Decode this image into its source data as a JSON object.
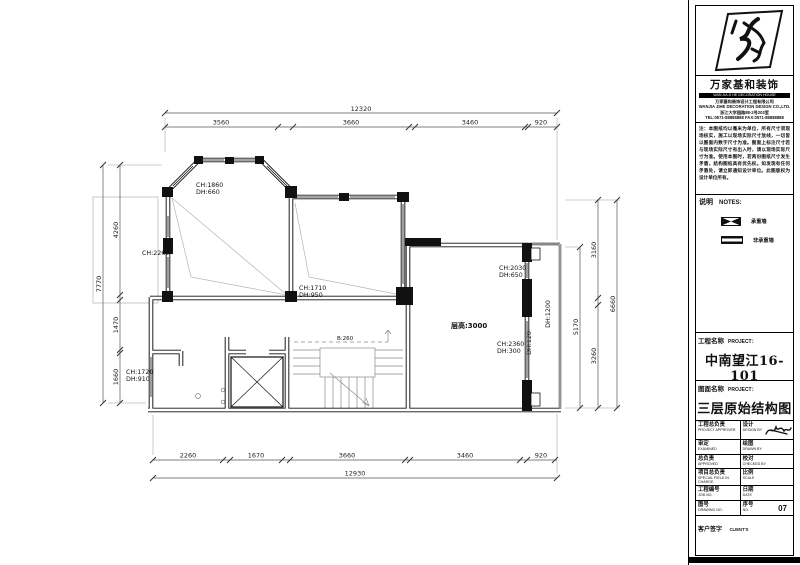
{
  "plan": {
    "dims": {
      "top_overall": "12320",
      "top_segments": [
        "3560",
        "3660",
        "3460",
        "920"
      ],
      "bottom_segments": [
        "2260",
        "1670",
        "3660",
        "3460",
        "920"
      ],
      "bottom_overall": "12930",
      "left_overall": "7770",
      "left_segments": [
        "4260",
        "1470",
        "1660"
      ],
      "right_overall": "6660",
      "right_inner": "5170",
      "right_segments": [
        "3160",
        "3260"
      ]
    },
    "labels": {
      "room1_ch": "CH:1860",
      "room1_dh": "DH:660",
      "left_wall_ch": "CH:2260",
      "room2_ch": "CH:1710",
      "room2_dh": "DH:950",
      "storey_height": "层高:3000",
      "right_door_ch": "CH:2030",
      "right_door_dh": "DH:650",
      "right_win_ch": "CH:2360",
      "right_win_dh": "DH:300",
      "balcony_dh": "DH:1200",
      "sill_dh": "DH:120",
      "left_win_ch": "CH:1720",
      "left_win_dh": "DH:910",
      "stair_note": "B:260"
    }
  },
  "titleblock": {
    "company_cn": "万家基和装饰",
    "company_en_band": "WAN JIA JI HE DECORATION HOUSE",
    "address_lines": "万家基和装饰设计工程有限公司\nWANJIA JIHE DECORATION DESIGN CO.,LTD.\n浙江大学园路88-2号203室\nTEL:0571-88888888  FAX:0571-88888888",
    "notes_paragraph": "注：本图纸均以毫米为单位，所有尺寸须现场核实，施工以现场实际尺寸放线，一切皆以图面内数字尺寸为准。图面上标注尺寸若与现场实际尺寸有出入时，请以现场实际尺寸为准。使用本图时，若两份图纸尺寸发生矛盾，结构图纸具有优先权。如发现有任何矛盾处，请立即通知设计单位。此图版权为设计单位所有。",
    "notes_header_cn": "说明",
    "notes_header_en": "NOTES:",
    "legend": [
      {
        "label": "承重墙"
      },
      {
        "label": "非承重墙"
      }
    ],
    "project": {
      "label_cn": "工程名称",
      "label_en": "PROJECT：",
      "value": "中南望江16-101"
    },
    "drawing": {
      "label_cn": "图面名称",
      "label_en": "PROJECT：",
      "value": "三层原始结构图"
    },
    "table": [
      {
        "l_cn": "工程总负责",
        "l_en": "PROJECT APPROVER",
        "r_cn": "设计",
        "r_en": "DESIGN BY",
        "r_val": ""
      },
      {
        "l_cn": "审定",
        "l_en": "EXAMINED",
        "r_cn": "绘图",
        "r_en": "DRAWN BY",
        "r_val": ""
      },
      {
        "l_cn": "总负责",
        "l_en": "APPROVED",
        "r_cn": "校对",
        "r_en": "CHECKED BY",
        "r_val": ""
      },
      {
        "l_cn": "项目总负责",
        "l_en": "SPECIAL FIELD IN CHARGE",
        "r_cn": "比例",
        "r_en": "SCALE",
        "r_val": ""
      },
      {
        "l_cn": "工程编号",
        "l_en": "JOB NO.",
        "r_cn": "日期",
        "r_en": "DATE",
        "r_val": ""
      },
      {
        "l_cn": "图号",
        "l_en": "DRAWING NO.",
        "r_cn": "序号",
        "r_en": "NO.",
        "r_val": "07"
      }
    ],
    "client": {
      "label_cn": "客户签字",
      "label_en": "CLIENT'S"
    }
  }
}
